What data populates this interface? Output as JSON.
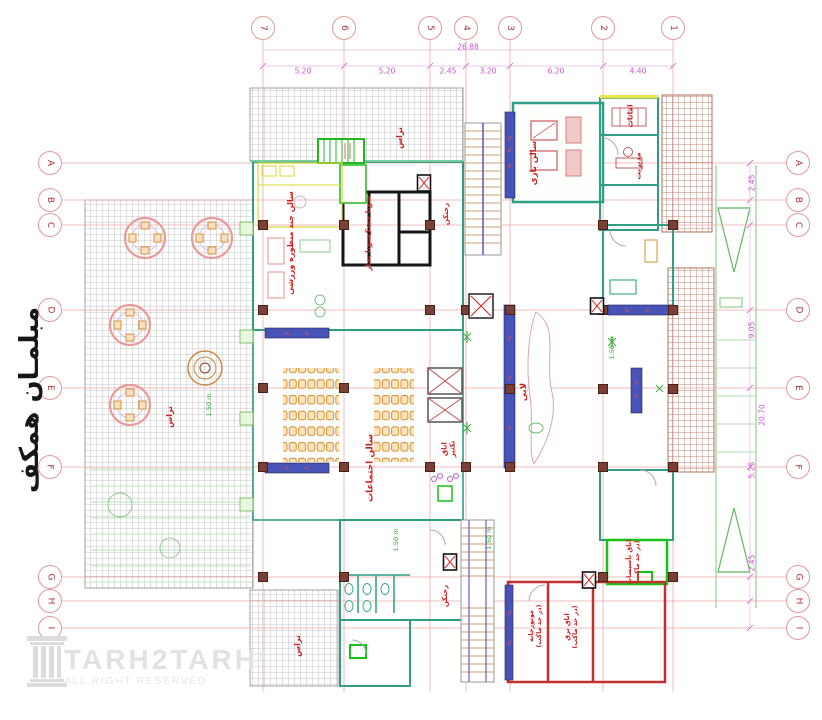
{
  "page": {
    "background": "#ffffff"
  },
  "side_title": "مبلمـان همکف",
  "watermark": {
    "brand": "TARH2TARH",
    "registered": "®",
    "subtitle": "ALL RIGHT RESERVED"
  },
  "grid": {
    "columns": [
      {
        "label": "7",
        "x": 263
      },
      {
        "label": "6",
        "x": 344
      },
      {
        "label": "5",
        "x": 430
      },
      {
        "label": "4",
        "x": 466
      },
      {
        "label": "3",
        "x": 510
      },
      {
        "label": "2",
        "x": 603
      },
      {
        "label": "1",
        "x": 673
      }
    ],
    "rows": [
      {
        "label": "A",
        "y": 163
      },
      {
        "label": "B",
        "y": 200
      },
      {
        "label": "C",
        "y": 225
      },
      {
        "label": "D",
        "y": 310
      },
      {
        "label": "E",
        "y": 388
      },
      {
        "label": "F",
        "y": 467
      },
      {
        "label": "G",
        "y": 577
      },
      {
        "label": "H",
        "y": 601
      },
      {
        "label": "I",
        "y": 628
      }
    ],
    "dims_top": {
      "total": "26.88",
      "total_x": 468,
      "total_y": 47,
      "segments": [
        {
          "v": "5.20",
          "x": 303
        },
        {
          "v": "5.20",
          "x": 387
        },
        {
          "v": "2.45",
          "x": 448
        },
        {
          "v": "3.20",
          "x": 488
        },
        {
          "v": "6.20",
          "x": 556
        },
        {
          "v": "4.40",
          "x": 638
        }
      ]
    },
    "dims_right": [
      {
        "v": "2.45",
        "x": 752,
        "y": 183
      },
      {
        "v": "9.05",
        "x": 752,
        "y": 330
      },
      {
        "v": "20.70",
        "x": 762,
        "y": 415
      },
      {
        "v": "5.25",
        "x": 752,
        "y": 470
      },
      {
        "v": "2.45",
        "x": 752,
        "y": 563
      }
    ]
  },
  "rooms": [
    {
      "label": "تراس",
      "x": 400,
      "y": 138,
      "fs": 8
    },
    {
      "label": "سالن بازی",
      "x": 534,
      "y": 163,
      "fs": 8.5
    },
    {
      "label": "امانات",
      "x": 630,
      "y": 116,
      "fs": 7.5
    },
    {
      "label": "مدیریت",
      "x": 638,
      "y": 166,
      "fs": 7.5
    },
    {
      "label": "سالن چند منظوره ورزشی",
      "x": 291,
      "y": 243,
      "fs": 8
    },
    {
      "label": "سونا خشک",
      "x": 368,
      "y": 216,
      "fs": 7.5
    },
    {
      "label": "سونا بخار",
      "x": 368,
      "y": 253,
      "fs": 7.5
    },
    {
      "label": "رختکن",
      "x": 446,
      "y": 214,
      "fs": 7
    },
    {
      "label": "لابی",
      "x": 524,
      "y": 392,
      "fs": 8.5
    },
    {
      "label": "سالن اجتماعات",
      "x": 371,
      "y": 468,
      "fs": 9
    },
    {
      "label": "اتاق\nتکثیر",
      "x": 449,
      "y": 449,
      "fs": 7
    },
    {
      "label": "تراس",
      "x": 170,
      "y": 417,
      "fs": 8
    },
    {
      "label": "رختکن",
      "x": 445,
      "y": 596,
      "fs": 7
    },
    {
      "label": "موتورخانه\n(در حد ماکت)",
      "x": 536,
      "y": 626,
      "fs": 6.5
    },
    {
      "label": "اتاق برق\n(در حد ماکت)",
      "x": 572,
      "y": 627,
      "fs": 6.5
    },
    {
      "label": "اتاق تأسیسات\n(در حد ماکت)",
      "x": 634,
      "y": 562,
      "fs": 6.5
    },
    {
      "label": "تراس",
      "x": 298,
      "y": 646,
      "fs": 8
    }
  ],
  "annotations": [
    {
      "v": "1.50 m",
      "x": 396,
      "y": 540
    },
    {
      "v": "1.50 m",
      "x": 489,
      "y": 538
    },
    {
      "v": "1.50 m",
      "x": 612,
      "y": 348
    },
    {
      "v": "1.50 m",
      "x": 209,
      "y": 405
    }
  ],
  "colors": {
    "axis": "#eba7a7",
    "bubble_text": "#b03030",
    "dim_text": "#cc55cc",
    "room_label": "#cf2020",
    "wall_teal": "#2f9e82",
    "wall_red": "#c23030",
    "wall_green": "#17c217",
    "vitrine_blue": "#4853b8",
    "hatch_gray": "#8f8f8f",
    "hatch_brown": "#a5604a",
    "annotation_green": "#2fae2f",
    "column_fill": "#7a4036"
  },
  "plan": {
    "columns_px": [
      [
        263,
        225
      ],
      [
        344,
        225
      ],
      [
        430,
        225
      ],
      [
        603,
        225
      ],
      [
        673,
        225
      ],
      [
        263,
        310
      ],
      [
        430,
        310
      ],
      [
        466,
        310
      ],
      [
        510,
        310
      ],
      [
        603,
        310
      ],
      [
        673,
        310
      ],
      [
        263,
        388
      ],
      [
        344,
        388
      ],
      [
        510,
        389
      ],
      [
        603,
        389
      ],
      [
        673,
        389
      ],
      [
        263,
        467
      ],
      [
        344,
        467
      ],
      [
        430,
        467
      ],
      [
        466,
        467
      ],
      [
        510,
        467
      ],
      [
        603,
        467
      ],
      [
        673,
        467
      ],
      [
        263,
        577
      ],
      [
        344,
        577
      ],
      [
        603,
        577
      ],
      [
        673,
        577
      ]
    ],
    "fire_boxes": [
      [
        424,
        183
      ],
      [
        597,
        306
      ],
      [
        450,
        562
      ],
      [
        589,
        580
      ]
    ],
    "duct_box": [
      481,
      306
    ]
  }
}
